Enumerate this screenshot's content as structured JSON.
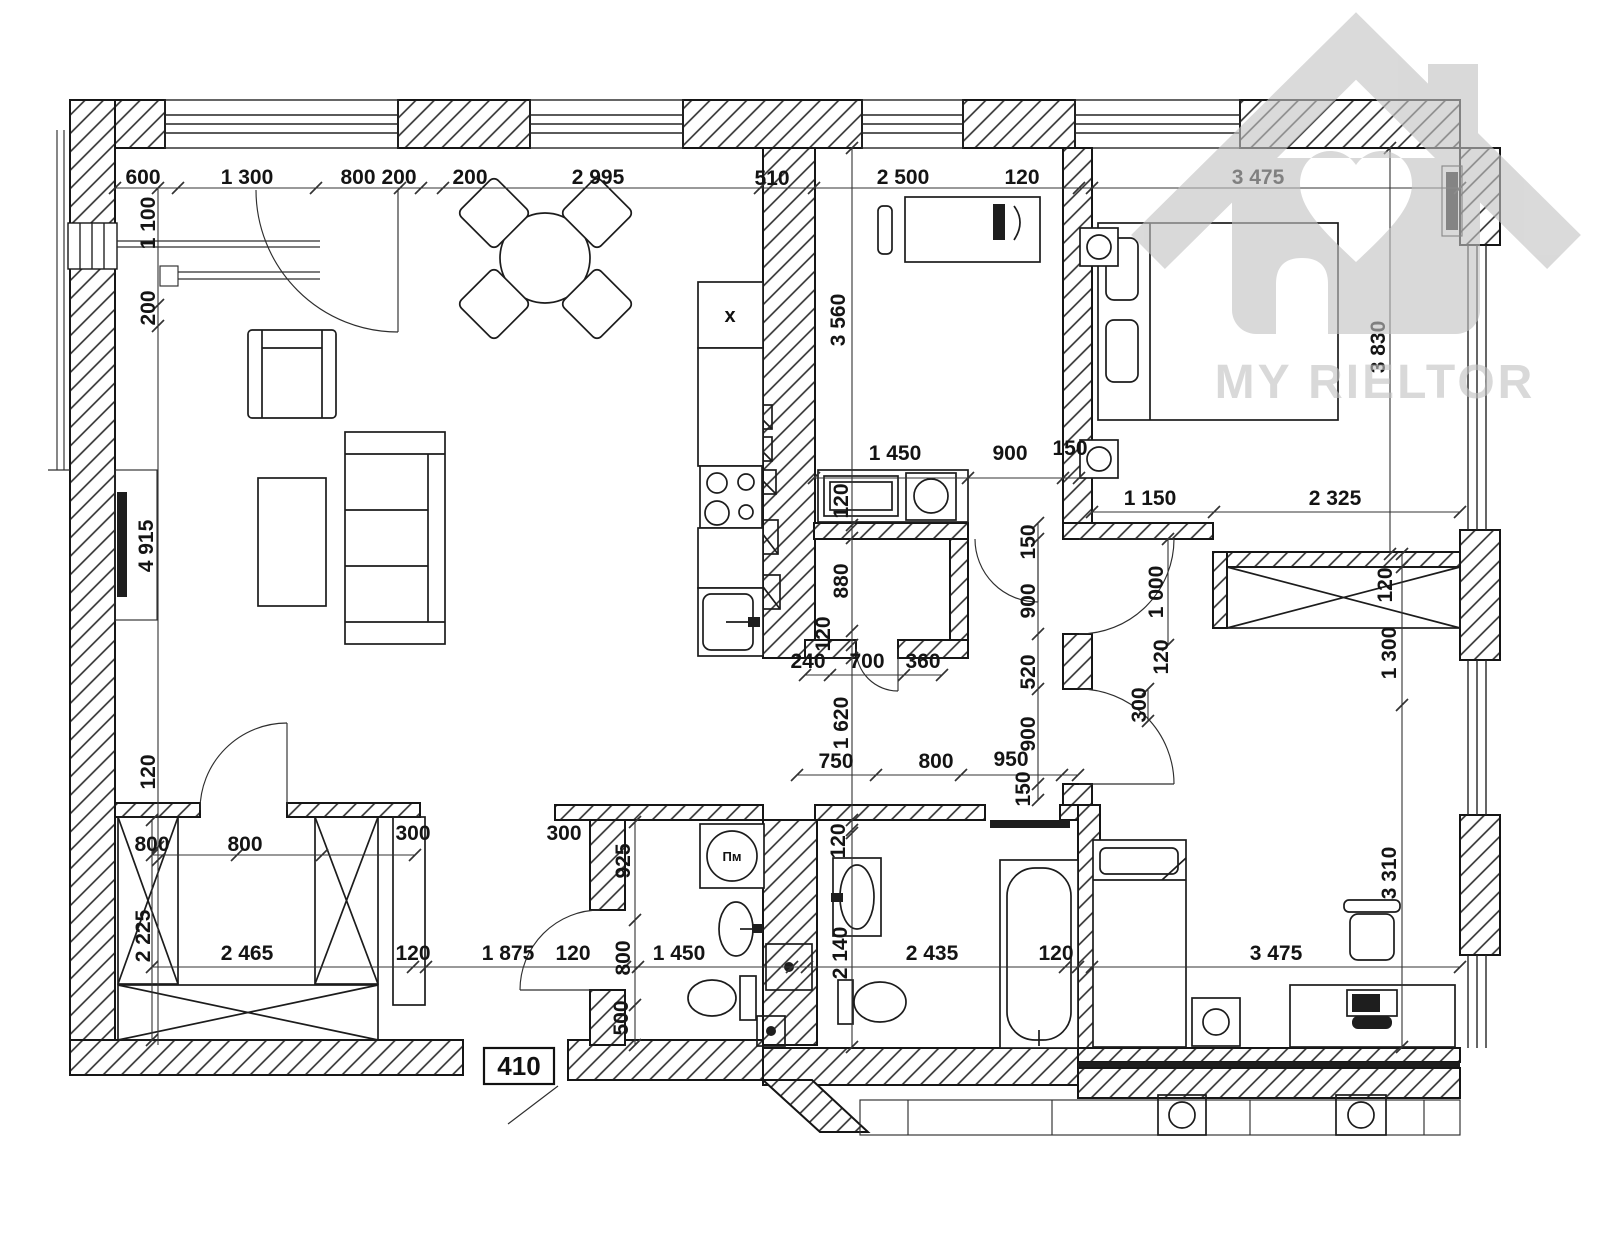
{
  "plan": {
    "apartment_number": "410"
  },
  "labels": {
    "washing_machine": "Пм",
    "cabinet_mark": "x"
  },
  "watermark": {
    "text": "MY RIELTOR",
    "color": "#c3c3c3"
  },
  "colors": {
    "wall_line": "#161616",
    "hatch": "#2b2b2b",
    "dark_fill": "#1e1e1e"
  },
  "dimensions": [
    {
      "t": "600",
      "x": 143,
      "y": 184
    },
    {
      "t": "1 300",
      "x": 247,
      "y": 184
    },
    {
      "t": "800",
      "x": 358,
      "y": 184
    },
    {
      "t": "200",
      "x": 399,
      "y": 184
    },
    {
      "t": "200",
      "x": 470,
      "y": 184
    },
    {
      "t": "2 995",
      "x": 598,
      "y": 184
    },
    {
      "t": "510",
      "x": 772,
      "y": 185
    },
    {
      "t": "2 500",
      "x": 903,
      "y": 184
    },
    {
      "t": "120",
      "x": 1022,
      "y": 184
    },
    {
      "t": "3 475",
      "x": 1258,
      "y": 184
    },
    {
      "t": "1 450",
      "x": 895,
      "y": 460
    },
    {
      "t": "900",
      "x": 1010,
      "y": 460
    },
    {
      "t": "150",
      "x": 1070,
      "y": 455
    },
    {
      "t": "1 150",
      "x": 1150,
      "y": 505
    },
    {
      "t": "2 325",
      "x": 1335,
      "y": 505
    },
    {
      "t": "240",
      "x": 808,
      "y": 668
    },
    {
      "t": "700",
      "x": 867,
      "y": 668
    },
    {
      "t": "360",
      "x": 923,
      "y": 668
    },
    {
      "t": "750",
      "x": 836,
      "y": 768
    },
    {
      "t": "800",
      "x": 936,
      "y": 768
    },
    {
      "t": "950",
      "x": 1011,
      "y": 766
    },
    {
      "t": "800",
      "x": 152,
      "y": 851
    },
    {
      "t": "800",
      "x": 245,
      "y": 851
    },
    {
      "t": "300",
      "x": 413,
      "y": 840
    },
    {
      "t": "2 465",
      "x": 247,
      "y": 960
    },
    {
      "t": "120",
      "x": 413,
      "y": 960
    },
    {
      "t": "1 875",
      "x": 508,
      "y": 960
    },
    {
      "t": "300",
      "x": 564,
      "y": 840
    },
    {
      "t": "120",
      "x": 573,
      "y": 960
    },
    {
      "t": "1 450",
      "x": 679,
      "y": 960
    },
    {
      "t": "2 435",
      "x": 932,
      "y": 960
    },
    {
      "t": "120",
      "x": 1056,
      "y": 960
    },
    {
      "t": "3 475",
      "x": 1276,
      "y": 960
    },
    {
      "t": "1 100",
      "x": 155,
      "y": 223,
      "r": 1
    },
    {
      "t": "200",
      "x": 155,
      "y": 308,
      "r": 1
    },
    {
      "t": "4 915",
      "x": 153,
      "y": 546,
      "r": 1
    },
    {
      "t": "120",
      "x": 155,
      "y": 772,
      "r": 1
    },
    {
      "t": "2 225",
      "x": 150,
      "y": 936,
      "r": 1
    },
    {
      "t": "3 560",
      "x": 845,
      "y": 320,
      "r": 1
    },
    {
      "t": "120",
      "x": 848,
      "y": 501,
      "r": 1
    },
    {
      "t": "880",
      "x": 848,
      "y": 581,
      "r": 1
    },
    {
      "t": "120",
      "x": 830,
      "y": 634,
      "r": 1
    },
    {
      "t": "1 620",
      "x": 848,
      "y": 723,
      "r": 1
    },
    {
      "t": "150",
      "x": 1035,
      "y": 542,
      "r": 1
    },
    {
      "t": "900",
      "x": 1035,
      "y": 601,
      "r": 1
    },
    {
      "t": "520",
      "x": 1035,
      "y": 672,
      "r": 1
    },
    {
      "t": "900",
      "x": 1035,
      "y": 734,
      "r": 1
    },
    {
      "t": "150",
      "x": 1030,
      "y": 789,
      "r": 1
    },
    {
      "t": "1 000",
      "x": 1163,
      "y": 592,
      "r": 1
    },
    {
      "t": "120",
      "x": 1392,
      "y": 585,
      "r": 1
    },
    {
      "t": "1 300",
      "x": 1396,
      "y": 653,
      "r": 1
    },
    {
      "t": "120",
      "x": 1168,
      "y": 657,
      "r": 1
    },
    {
      "t": "300",
      "x": 1146,
      "y": 705,
      "r": 1
    },
    {
      "t": "3 830",
      "x": 1385,
      "y": 347,
      "r": 1
    },
    {
      "t": "925",
      "x": 630,
      "y": 861,
      "r": 1
    },
    {
      "t": "800",
      "x": 630,
      "y": 958,
      "r": 1
    },
    {
      "t": "500",
      "x": 628,
      "y": 1018,
      "r": 1
    },
    {
      "t": "120",
      "x": 845,
      "y": 841,
      "r": 1
    },
    {
      "t": "2 140",
      "x": 847,
      "y": 953,
      "r": 1
    },
    {
      "t": "3 310",
      "x": 1396,
      "y": 873,
      "r": 1
    }
  ]
}
